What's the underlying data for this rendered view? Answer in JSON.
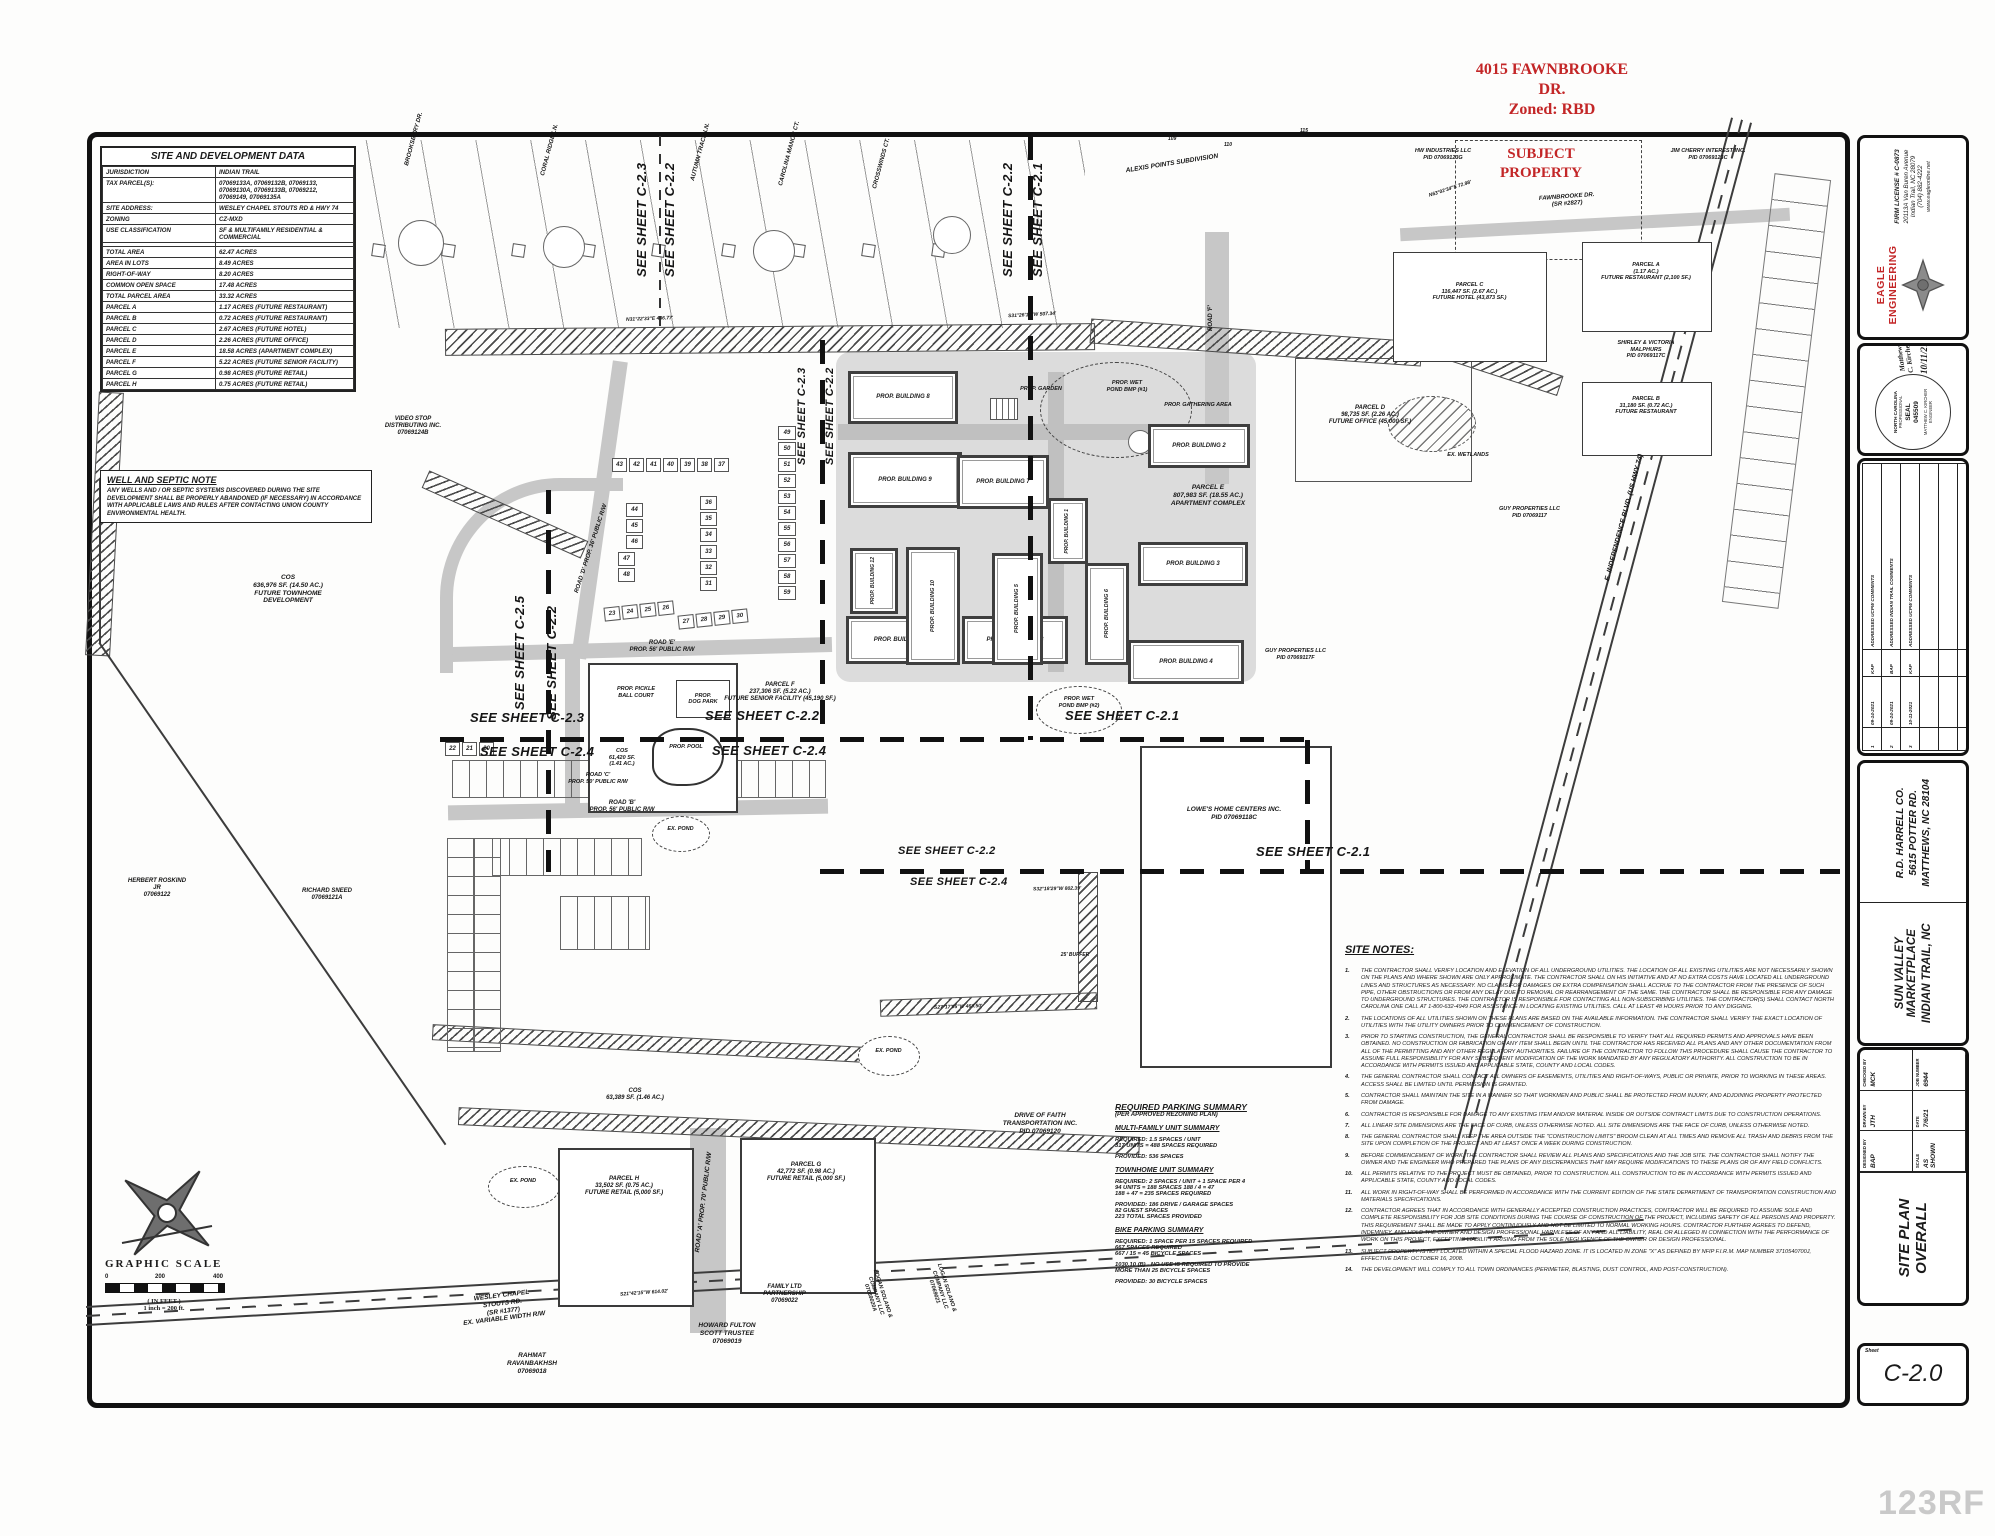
{
  "red_annotations": {
    "address": "4015 FAWNBROOKE\nDR.\nZoned: RBD",
    "subject": "SUBJECT\nPROPERTY"
  },
  "site_data": {
    "title": "SITE AND DEVELOPMENT DATA",
    "rows": [
      [
        "JURISDICTION",
        "INDIAN TRAIL"
      ],
      [
        "TAX PARCEL(S):",
        "07069133A, 07069132B, 07069133,\n07069130A, 07069133B, 07069212,\n07069149, 07069135A"
      ],
      [
        "SITE ADDRESS:",
        "WESLEY CHAPEL STOUTS RD & HWY 74"
      ],
      [
        "ZONING",
        "CZ-MXD"
      ],
      [
        "USE CLASSIFICATION",
        "SF & MULTIFAMILY RESIDENTIAL & COMMERCIAL"
      ],
      [
        " ",
        " "
      ],
      [
        "TOTAL AREA",
        "62.47 ACRES"
      ],
      [
        "AREA IN LOTS",
        "8.49 ACRES"
      ],
      [
        "RIGHT-OF-WAY",
        "8.20 ACRES"
      ],
      [
        "COMMON OPEN SPACE",
        "17.48 ACRES"
      ],
      [
        "TOTAL PARCEL AREA",
        "33.32 ACRES"
      ],
      [
        "PARCEL A",
        "1.17 ACRES  (FUTURE RESTAURANT)"
      ],
      [
        "PARCEL B",
        "0.72 ACRES  (FUTURE RESTAURANT)"
      ],
      [
        "PARCEL C",
        "2.67 ACRES  (FUTURE HOTEL)"
      ],
      [
        "PARCEL D",
        "2.26 ACRES  (FUTURE OFFICE)"
      ],
      [
        "PARCEL E",
        "18.58 ACRES  (APARTMENT COMPLEX)"
      ],
      [
        "PARCEL F",
        "5.22 ACRES  (FUTURE SENIOR FACILITY)"
      ],
      [
        "PARCEL G",
        "0.98 ACRES  (FUTURE RETAIL)"
      ],
      [
        "PARCEL H",
        "0.75 ACRES  (FUTURE RETAIL)"
      ]
    ]
  },
  "well_septic": {
    "title": "WELL AND SEPTIC NOTE",
    "body": "ANY WELLS AND / OR SEPTIC SYSTEMS DISCOVERED DURING THE SITE DEVELOPMENT SHALL BE PROPERLY ABANDONED (IF NECESSARY) IN ACCORDANCE WITH APPLICABLE LAWS AND RULES AFTER CONTACTING UNION COUNTY ENVIRONMENTAL HEALTH."
  },
  "graphic_scale": {
    "title": "GRAPHIC SCALE",
    "tick0": "0",
    "tick200": "200",
    "tick400": "400",
    "units": "( IN FEET )",
    "ratio": "1 inch = 200 ft."
  },
  "sheets": {
    "c21": "SEE SHEET C-2.1",
    "c22": "SEE SHEET C-2.2",
    "c23": "SEE SHEET C-2.3",
    "c24": "SEE SHEET C-2.4",
    "c25": "SEE SHEET C-2.5"
  },
  "parking": {
    "title": "REQUIRED PARKING SUMMARY",
    "subtitle": "(PER APPROVED REZONING PLAN)",
    "mf_title": "MULTI-FAMILY UNIT SUMMARY",
    "mf_req": "REQUIRED: 1.5 SPACES / UNIT\n317 UNITS = 488 SPACES REQUIRED",
    "mf_prov": "PROVIDED: 536 SPACES",
    "th_title": "TOWNHOME UNIT SUMMARY",
    "th_req": "REQUIRED: 2 SPACES / UNIT  +  1 SPACE PER 4\n94 UNITS = 188 SPACES     188 / 4 = 47\n188 + 47 = 235 SPACES REQUIRED",
    "th_prov": "PROVIDED:  186 DRIVE / GARAGE SPACES\n82 GUEST SPACES\n223 TOTAL SPACES PROVIDED",
    "bike_title": "BIKE PARKING SUMMARY",
    "bike_req": "REQUIRED: 1 SPACE PER 15 SPACES REQUIRED\n667 SPACES REQUIRED\n667 / 15 = 45 BICYCLE SPACES",
    "bike_note": "1030.10 (B) - NO USE IS REQUIRED TO PROVIDE\nMORE THAN 25 BICYCLE SPACES",
    "bike_prov": "PROVIDED: 30 BICYCLE SPACES"
  },
  "site_notes": {
    "title": "SITE NOTES:",
    "notes": [
      {
        "n": "1.",
        "t": "THE CONTRACTOR SHALL VERIFY LOCATION AND ELEVATION OF ALL UNDERGROUND UTILITIES. THE LOCATION OF ALL EXISTING UTILITIES ARE NOT NECESSARILY SHOWN ON THE PLANS AND WHERE SHOWN ARE ONLY APPROXIMATE. THE CONTRACTOR SHALL ON HIS INITIATIVE AND AT NO EXTRA COSTS HAVE LOCATED ALL UNDERGROUND LINES AND STRUCTURES AS NECESSARY. NO CLAIMS FOR DAMAGES OR EXTRA COMPENSATION SHALL ACCRUE TO THE CONTRACTOR FROM THE PRESENCE OF SUCH PIPE, OTHER OBSTRUCTIONS OR FROM ANY DELAY DUE TO REMOVAL OR REARRANGEMENT OF THE SAME. THE CONTRACTOR SHALL BE RESPONSIBLE FOR ANY DAMAGE TO UNDERGROUND STRUCTURES. THE CONTRACTOR IS RESPONSIBLE FOR CONTACTING ALL NON-SUBSCRIBING UTILITIES. THE CONTRACTOR(S) SHALL CONTACT NORTH CAROLINA ONE CALL AT 1-800-632-4949 FOR ASSISTANCE IN LOCATING EXISTING UTILITIES. CALL AT LEAST 48 HOURS PRIOR TO ANY DIGGING."
      },
      {
        "n": "2.",
        "t": "THE LOCATIONS OF ALL UTILITIES SHOWN ON THESE PLANS ARE BASED ON THE AVAILABLE INFORMATION. THE CONTRACTOR SHALL VERIFY THE EXACT LOCATION OF UTILITIES WITH THE UTILITY OWNERS PRIOR TO COMMENCEMENT OF CONSTRUCTION."
      },
      {
        "n": "3.",
        "t": "PRIOR TO STARTING CONSTRUCTION, THE GENERAL CONTRACTOR SHALL BE RESPONSIBLE TO VERIFY THAT ALL REQUIRED PERMITS AND APPROVALS HAVE BEEN OBTAINED. NO CONSTRUCTION OR FABRICATION OF ANY ITEM SHALL BEGIN UNTIL THE CONTRACTOR HAS RECEIVED ALL PLANS AND ANY OTHER DOCUMENTATION FROM ALL OF THE PERMITTING AND ANY OTHER REGULATORY AUTHORITIES. FAILURE OF THE CONTRACTOR TO FOLLOW THIS PROCEDURE SHALL CAUSE THE CONTRACTOR TO ASSUME FULL RESPONSIBILITY FOR ANY SUBSEQUENT MODIFICATION OF THE WORK MANDATED BY ANY REGULATORY AUTHORITY. ALL CONSTRUCTION TO BE IN ACCORDANCE WITH PERMITS ISSUED AND APPLICABLE STATE, COUNTY AND LOCAL CODES."
      },
      {
        "n": "4.",
        "t": "THE GENERAL CONTRACTOR SHALL CONTACT ALL OWNERS OF EASEMENTS, UTILITIES AND RIGHT-OF-WAYS, PUBLIC OR PRIVATE, PRIOR TO WORKING IN THESE AREAS. ACCESS SHALL BE LIMITED UNTIL PERMISSION IS GRANTED."
      },
      {
        "n": "5.",
        "t": "CONTRACTOR SHALL MAINTAIN THE SITE IN A MANNER SO THAT WORKMEN AND PUBLIC SHALL BE PROTECTED FROM INJURY, AND ADJOINING PROPERTY PROTECTED FROM DAMAGE."
      },
      {
        "n": "6.",
        "t": "CONTRACTOR IS RESPONSIBLE FOR DAMAGE TO ANY EXISTING ITEM AND/OR MATERIAL INSIDE OR OUTSIDE CONTRACT LIMITS DUE TO CONSTRUCTION OPERATIONS."
      },
      {
        "n": "7.",
        "t": "ALL LINEAR SITE DIMENSIONS ARE THE FACE OF CURB, UNLESS OTHERWISE NOTED. ALL SITE DIMENSIONS ARE THE FACE OF CURB, UNLESS OTHERWISE NOTED."
      },
      {
        "n": "8.",
        "t": "THE GENERAL CONTRACTOR SHALL KEEP THE AREA OUTSIDE THE \"CONSTRUCTION LIMITS\" BROOM CLEAN AT ALL TIMES AND REMOVE ALL TRASH AND DEBRIS FROM THE SITE UPON COMPLETION OF THE PROJECT AND AT LEAST ONCE A WEEK DURING CONSTRUCTION."
      },
      {
        "n": "9.",
        "t": "BEFORE COMMENCEMENT OF WORK, THE CONTRACTOR SHALL REVIEW ALL PLANS AND SPECIFICATIONS AND THE JOB SITE. THE CONTRACTOR SHALL NOTIFY THE OWNER AND THE ENGINEER WHO PREPARED THE PLANS OF ANY DISCREPANCIES THAT MAY REQUIRE MODIFICATIONS TO THESE PLANS OR OF ANY FIELD CONFLICTS."
      },
      {
        "n": "10.",
        "t": "ALL PERMITS RELATIVE TO THE PROJECT MUST BE OBTAINED, PRIOR TO CONSTRUCTION. ALL CONSTRUCTION TO BE IN ACCORDANCE WITH PERMITS ISSUED AND APPLICABLE STATE, COUNTY AND LOCAL CODES."
      },
      {
        "n": "11.",
        "t": "ALL WORK IN RIGHT-OF-WAY SHALL BE PERFORMED IN ACCORDANCE WITH THE CURRENT EDITION OF THE STATE DEPARTMENT OF TRANSPORTATION CONSTRUCTION AND MATERIALS SPECIFICATIONS."
      },
      {
        "n": "12.",
        "t": "CONTRACTOR AGREES THAT IN ACCORDANCE WITH GENERALLY ACCEPTED CONSTRUCTION PRACTICES, CONTRACTOR WILL BE REQUIRED TO ASSUME SOLE AND COMPLETE RESPONSIBILITY FOR JOB SITE CONDITIONS DURING THE COURSE OF CONSTRUCTION OF THE PROJECT, INCLUDING SAFETY OF ALL PERSONS AND PROPERTY. THIS REQUIREMENT SHALL BE MADE TO APPLY CONTINUOUSLY AND NOT BE LIMITED TO NORMAL WORKING HOURS. CONTRACTOR FURTHER AGREES TO DEFEND, INDEMNIFY, AND HOLD THE OWNER AND DESIGN PROFESSIONAL HARMLESS OF ANY AND ALL LIABILITY, REAL OR ALLEGED IN CONNECTION WITH THE PERFORMANCE OF WORK ON THIS PROJECT, EXCEPTING LIABILITY ARISING FROM THE SOLE NEGLIGENCE OF THE OWNER OR DESIGN PROFESSIONAL."
      },
      {
        "n": "13.",
        "t": "SUBJECT PROPERTY IS NOT LOCATED WITHIN A SPECIAL FLOOD HAZARD ZONE. IT IS LOCATED IN ZONE \"X\" AS DEFINED BY NFIP F.I.R.M. MAP NUMBER 3710540700J, EFFECTIVE DATE: OCTOBER 16, 2008."
      },
      {
        "n": "14.",
        "t": "THE DEVELOPMENT WILL COMPLY TO ALL TOWN ORDINANCES (PERIMETER, BLASTING, DUST CONTROL, AND POST-CONSTRUCTION)."
      }
    ]
  },
  "map": {
    "labels": {
      "alexis": "ALEXIS POINTS SUBDIVISION",
      "brooksbury": "BROOKSBURY DR.",
      "coral": "CORAL RIDGE LN.",
      "autumn": "AUTUMN TRACE LN.",
      "carolina": "CAROLINA MANOR CT.",
      "crosswinds": "CROSSWINDS CT.",
      "fawnbrooke": "FAWNBROOKE DR.\n(SR #2827)",
      "hw": "HW INDUSTRIES LLC\nPID 07069123G",
      "jim": "JIM CHERRY INTEREST INC.\nPID 07069123C",
      "malphurs": "SHIRLEY & VICTORIA\nMALPHURS\nPID 07069117C",
      "parcel_a": "PARCEL A\n(1.17 AC.)\nFUTURE RESTAURANT (2,100 SF.)",
      "parcel_b": "PARCEL B\n31,180 SF. (0.72 AC.)\nFUTURE RESTAURANT",
      "parcel_c": "PARCEL C\n116,447 SF. (2.67 AC.)\nFUTURE HOTEL (43,873 SF.)",
      "parcel_d": "PARCEL D\n98,735 SF. (2.26 AC.)\nFUTURE OFFICE (45,000 SF.)",
      "parcel_e": "PARCEL E\n807,983 SF. (18.55 AC.)\nAPARTMENT COMPLEX",
      "parcel_f": "PARCEL F\n237,306 SF. (5.22 AC.)\nFUTURE SENIOR FACILITY (45,190 SF.)",
      "parcel_g": "PARCEL G\n42,772 SF. (0.98 AC.)\nFUTURE RETAIL (5,000 SF.)",
      "parcel_h": "PARCEL H\n33,502 SF. (0.75 AC.)\nFUTURE RETAIL (5,000 SF.)",
      "cos_town": "COS\n636,976 SF. (14.50 AC.)\nFUTURE TOWNHOME\nDEVELOPMENT",
      "cos_small": "COS\n61,420 SF.\n(1.41 AC.)",
      "cos_g": "COS\n63,389 SF. (1.46 AC.)",
      "video": "VIDEO STOP\nDISTRIBUTING INC.\n07069124B",
      "roskind": "HERBERT ROSKIND\nJR\n07069122",
      "sneed": "RICHARD SNEED\n07069121A",
      "rahmat": "RAHMAT\nRAVANBAKHSH\n07069018",
      "wesley": "WESLEY CHAPEL\nSTOUTS RD.\n(SR #1377)\nEX. VARIABLE WIDTH R/W",
      "howard": "HOWARD FULTON\nSCOTT TRUSTEE\n07069019",
      "family": "FAMILY LTD\nPARTNERSHIP\n07069022",
      "drive_faith": "DRIVE OF FAITH\nTRANSPORTATION INC.\nPID 07069120",
      "logan1": "LOGAN SOLANO &\nCOMPANY LLC\n07069020A",
      "logan2": "LOGAN SOLANO &\nCOMPANY LLC\n07069021",
      "lowes": "LOWE'S HOME CENTERS INC.\nPID 07069118C",
      "guy1": "GUY PROPERTIES LLC\nPID 07069117",
      "guy2": "GUY PROPERTIES LLC\nPID 07069117F",
      "independence": "E. INDEPENDENCE BLVD. (US HWY 74)",
      "wetlands": "EX. WETLANDS",
      "pond": "EX. POND",
      "buffer25": "25' BUFFER",
      "road_a": "ROAD 'A'\nPROP. 70' PUBLIC R/W",
      "road_b": "ROAD 'B'\nPROP. 56' PUBLIC R/W",
      "road_c": "ROAD 'C'\nPROP. 50' PUBLIC R/W",
      "road_d": "ROAD 'D'\nPROP. 36' PUBLIC R/W",
      "road_e": "ROAD 'E'\nPROP. 56' PUBLIC R/W",
      "road_f": "ROAD 'F'",
      "garden": "PROP. GARDEN",
      "wet1": "PROP. WET\nPOND BMP (#1)",
      "wet2": "PROP. WET\nPOND BMP (#2)",
      "gathering": "PROP. GATHERING AREA",
      "pickle": "PROP. PICKLE\nBALL COURT",
      "dogpark": "PROP.\nDOG PARK",
      "pool": "PROP. POOL"
    },
    "buildings": [
      "PROP. BUILDING 1",
      "PROP. BUILDING 2",
      "PROP. BUILDING 3",
      "PROP. BUILDING 4",
      "PROP. BUILDING 5",
      "PROP. BUILDING 6",
      "PROP. BUILDING 7",
      "PROP. BUILDING 8",
      "PROP. BUILDING 9",
      "PROP. BUILDING 10",
      "PROP. BUILDING 11",
      "PROP. BUILDING 12",
      "PROP. BUILDING 13"
    ],
    "lots": {
      "rowA": [
        "43",
        "42",
        "41",
        "40",
        "39",
        "38",
        "37"
      ],
      "colB1": [
        "44",
        "45",
        "46"
      ],
      "colB2": [
        "47",
        "48"
      ],
      "colD1": [
        "36",
        "35",
        "34"
      ],
      "colD2": [
        "33",
        "32",
        "31"
      ],
      "rowE": [
        "23",
        "24",
        "25",
        "26"
      ],
      "rowF": [
        "27",
        "28",
        "29",
        "30"
      ],
      "rowG": [
        "22",
        "21",
        "20"
      ],
      "colC": [
        "49",
        "50",
        "51",
        "52",
        "53",
        "54",
        "55",
        "56",
        "57",
        "58",
        "59"
      ]
    },
    "sub_lots": [
      "109",
      "110",
      "115"
    ],
    "bearings": [
      "N31°22'33\"E  436.77'",
      "S31°26'13\"W  507.34'",
      "S21°42'15\"W  614.02'",
      "S27°17'05\"W  468.50'",
      "S32°18'29\"W  802.39'",
      "N63°02'34\"E  72.98'"
    ]
  },
  "title_block": {
    "firm": {
      "name": "EAGLE ENGINEERING",
      "license": "FIRM LICENSE # C-0873",
      "address1": "20113A Van Buren Avenue",
      "address2": "Indian Trail, NC 28079",
      "phone": "(704) 882-4222",
      "web": "www.eagleonline.net"
    },
    "seal": {
      "org": "NORTH CAROLINA",
      "profession": "PROFESSIONAL",
      "seal_label": "SEAL",
      "seal_number": "045509",
      "name": "MATTHEW C. KIRCHER",
      "role": "ENGINEER",
      "signature": "Matthew C. Kircher",
      "date": "10/11/21"
    },
    "revisions": {
      "headers": [
        "NO.",
        "DATE",
        "BY",
        "ISSUE"
      ],
      "rows": [
        [
          "1",
          "09-14-2021",
          "KAP",
          "ADDRESSED UCPW COMMENTS"
        ],
        [
          "2",
          "09-24-2021",
          "BAP",
          "ADDRESSED INDIAN TRAIL COMMENTS"
        ],
        [
          "3",
          "10-11-2021",
          "KAP",
          "ADDRESSED UCPW COMMENTS"
        ],
        [
          "",
          "",
          "",
          ""
        ],
        [
          "",
          "",
          "",
          ""
        ]
      ]
    },
    "project": {
      "name1": "SUN VALLEY MARKETPLACE",
      "name2": "INDIAN TRAIL, NC",
      "client1": "R.D. HARRELL CO.",
      "client2": "5615 POTTER RD.",
      "client3": "MATTHEWS, NC  28104"
    },
    "sheet_title1": "SITE PLAN",
    "sheet_title2": "OVERALL",
    "fields": [
      {
        "k": "DESIGNED BY",
        "v": "BAP"
      },
      {
        "k": "DRAWN BY",
        "v": "JTH"
      },
      {
        "k": "CHECKED BY",
        "v": "MCK"
      },
      {
        "k": "SCALE",
        "v": "AS SHOWN"
      },
      {
        "k": "DATE",
        "v": "7/6/21"
      },
      {
        "k": "JOB NUMBER",
        "v": "6944"
      }
    ],
    "sheet_label": "Sheet",
    "sheet_number": "C-2.0"
  },
  "watermark": "123RF"
}
